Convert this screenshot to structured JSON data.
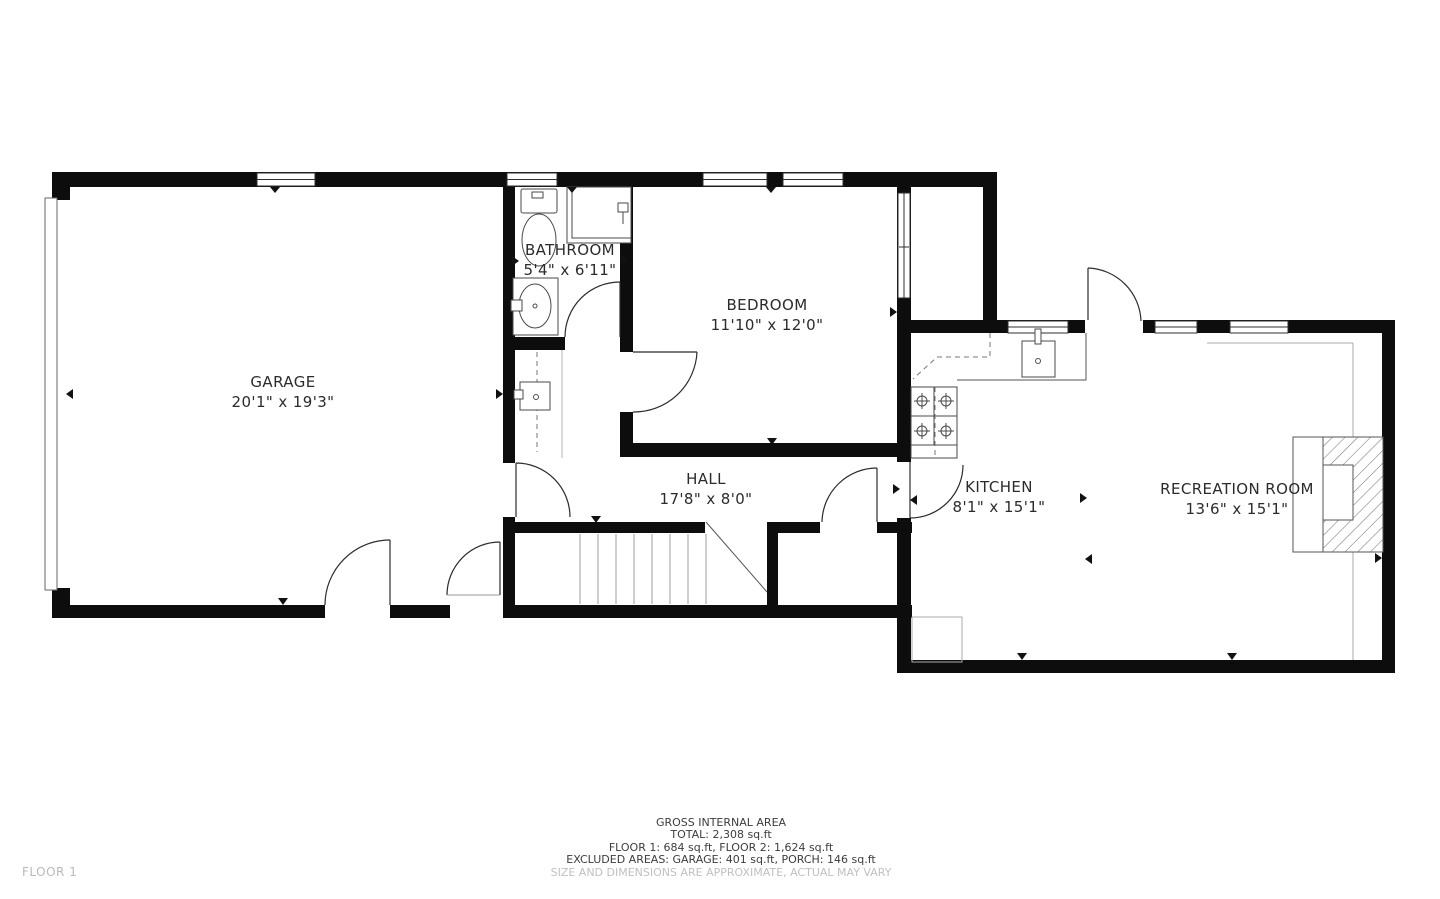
{
  "floor_label": "FLOOR 1",
  "rooms": [
    {
      "name": "GARAGE",
      "dims": "20'1\" x 19'3\""
    },
    {
      "name": "BATHROOM",
      "dims": "5'4\" x 6'11\""
    },
    {
      "name": "BEDROOM",
      "dims": "11'10\" x 12'0\""
    },
    {
      "name": "HALL",
      "dims": "17'8\" x 8'0\""
    },
    {
      "name": "KITCHEN",
      "dims": "8'1\" x 15'1\""
    },
    {
      "name": "RECREATION ROOM",
      "dims": "13'6\" x 15'1\""
    }
  ],
  "footer": {
    "title": "GROSS INTERNAL AREA",
    "total": "TOTAL: 2,308 sq.ft",
    "floors": "FLOOR 1: 684 sq.ft, FLOOR 2: 1,624 sq.ft",
    "excluded": "EXCLUDED AREAS: GARAGE: 401 sq.ft, PORCH: 146 sq.ft",
    "disclaimer": "SIZE AND DIMENSIONS ARE APPROXIMATE, ACTUAL MAY VARY"
  },
  "fixtures": [
    "garage-door",
    "toilet",
    "shower",
    "bathroom-sink",
    "closet-unit",
    "staircase",
    "kitchen-counter",
    "kitchen-sink",
    "stove",
    "fireplace",
    "utility-box"
  ],
  "colors": {
    "wall": "#0d0d0d",
    "label_text": "#2b2b2b",
    "footer_text": "#3d3d3d",
    "muted_text": "#c0c0c0",
    "thin_line": "#9e9e9e"
  }
}
